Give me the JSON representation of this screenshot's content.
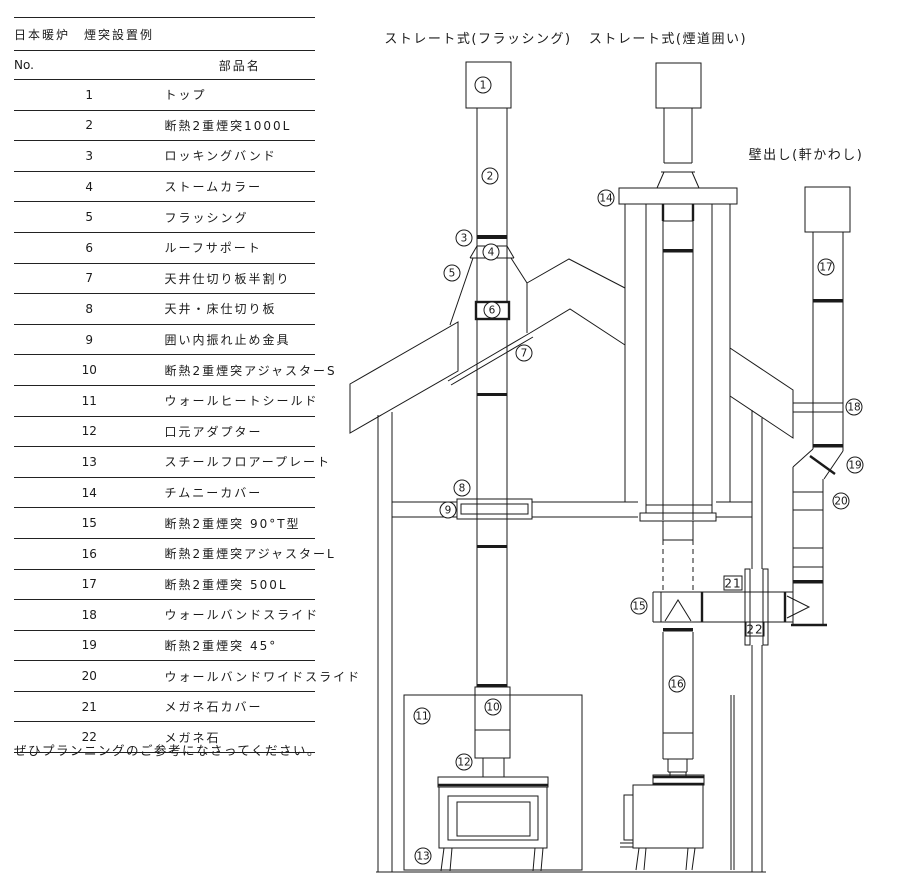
{
  "table": {
    "title": "日本暖炉　煙突設置例",
    "columns": {
      "no": "No.",
      "name": "部品名"
    },
    "rows": [
      {
        "no": "1",
        "name": "トップ"
      },
      {
        "no": "2",
        "name": "断熱2重煙突1000L"
      },
      {
        "no": "3",
        "name": "ロッキングバンド"
      },
      {
        "no": "4",
        "name": "ストームカラー"
      },
      {
        "no": "5",
        "name": "フラッシング"
      },
      {
        "no": "6",
        "name": "ルーフサポート"
      },
      {
        "no": "7",
        "name": "天井仕切り板半割り"
      },
      {
        "no": "8",
        "name": "天井・床仕切り板"
      },
      {
        "no": "9",
        "name": "囲い内振れ止め金具"
      },
      {
        "no": "10",
        "name": "断熱2重煙突アジャスターS"
      },
      {
        "no": "11",
        "name": "ウォールヒートシールド"
      },
      {
        "no": "12",
        "name": "口元アダプター"
      },
      {
        "no": "13",
        "name": "スチールフロアープレート"
      },
      {
        "no": "14",
        "name": "チムニーカバー"
      },
      {
        "no": "15",
        "name": "断熱2重煙突 90°T型"
      },
      {
        "no": "16",
        "name": "断熱2重煙突アジャスターL"
      },
      {
        "no": "17",
        "name": "断熱2重煙突 500L"
      },
      {
        "no": "18",
        "name": "ウォールバンドスライド"
      },
      {
        "no": "19",
        "name": "断熱2重煙突 45°"
      },
      {
        "no": "20",
        "name": "ウォールバンドワイドスライド"
      },
      {
        "no": "21",
        "name": "メガネ石カバー"
      },
      {
        "no": "22",
        "name": "メガネ石"
      }
    ]
  },
  "note": "ぜひプランニングのご参考になさってください。",
  "diagram": {
    "titles": {
      "flashing": "ストレート式(フラッシング)",
      "enclosure": "ストレート式(煙道囲い)",
      "wall_exit": "壁出し(軒かわし)"
    },
    "callouts": [
      {
        "label": "1",
        "x": 483,
        "y": 85,
        "circled": true
      },
      {
        "label": "2",
        "x": 490,
        "y": 176,
        "circled": true
      },
      {
        "label": "3",
        "x": 464,
        "y": 238,
        "circled": true
      },
      {
        "label": "4",
        "x": 491,
        "y": 252,
        "circled": true
      },
      {
        "label": "5",
        "x": 452,
        "y": 273,
        "circled": true
      },
      {
        "label": "6",
        "x": 492,
        "y": 310,
        "circled": true
      },
      {
        "label": "7",
        "x": 524,
        "y": 353,
        "circled": true
      },
      {
        "label": "8",
        "x": 462,
        "y": 488,
        "circled": true
      },
      {
        "label": "9",
        "x": 448,
        "y": 510,
        "circled": true
      },
      {
        "label": "10",
        "x": 493,
        "y": 707,
        "circled": true
      },
      {
        "label": "11",
        "x": 422,
        "y": 716,
        "circled": true
      },
      {
        "label": "12",
        "x": 464,
        "y": 762,
        "circled": true
      },
      {
        "label": "13",
        "x": 423,
        "y": 856,
        "circled": true
      },
      {
        "label": "14",
        "x": 606,
        "y": 198,
        "circled": true
      },
      {
        "label": "15",
        "x": 639,
        "y": 606,
        "circled": true
      },
      {
        "label": "16",
        "x": 677,
        "y": 684,
        "circled": true
      },
      {
        "label": "17",
        "x": 826,
        "y": 267,
        "circled": true
      },
      {
        "label": "18",
        "x": 854,
        "y": 407,
        "circled": true
      },
      {
        "label": "19",
        "x": 855,
        "y": 465,
        "circled": true
      },
      {
        "label": "20",
        "x": 841,
        "y": 501,
        "circled": true
      },
      {
        "label": "21",
        "x": 733,
        "y": 583,
        "circled": false
      },
      {
        "label": "22",
        "x": 755,
        "y": 629,
        "circled": false
      }
    ]
  },
  "colors": {
    "line": "#1a1a1a",
    "bg": "#ffffff"
  }
}
